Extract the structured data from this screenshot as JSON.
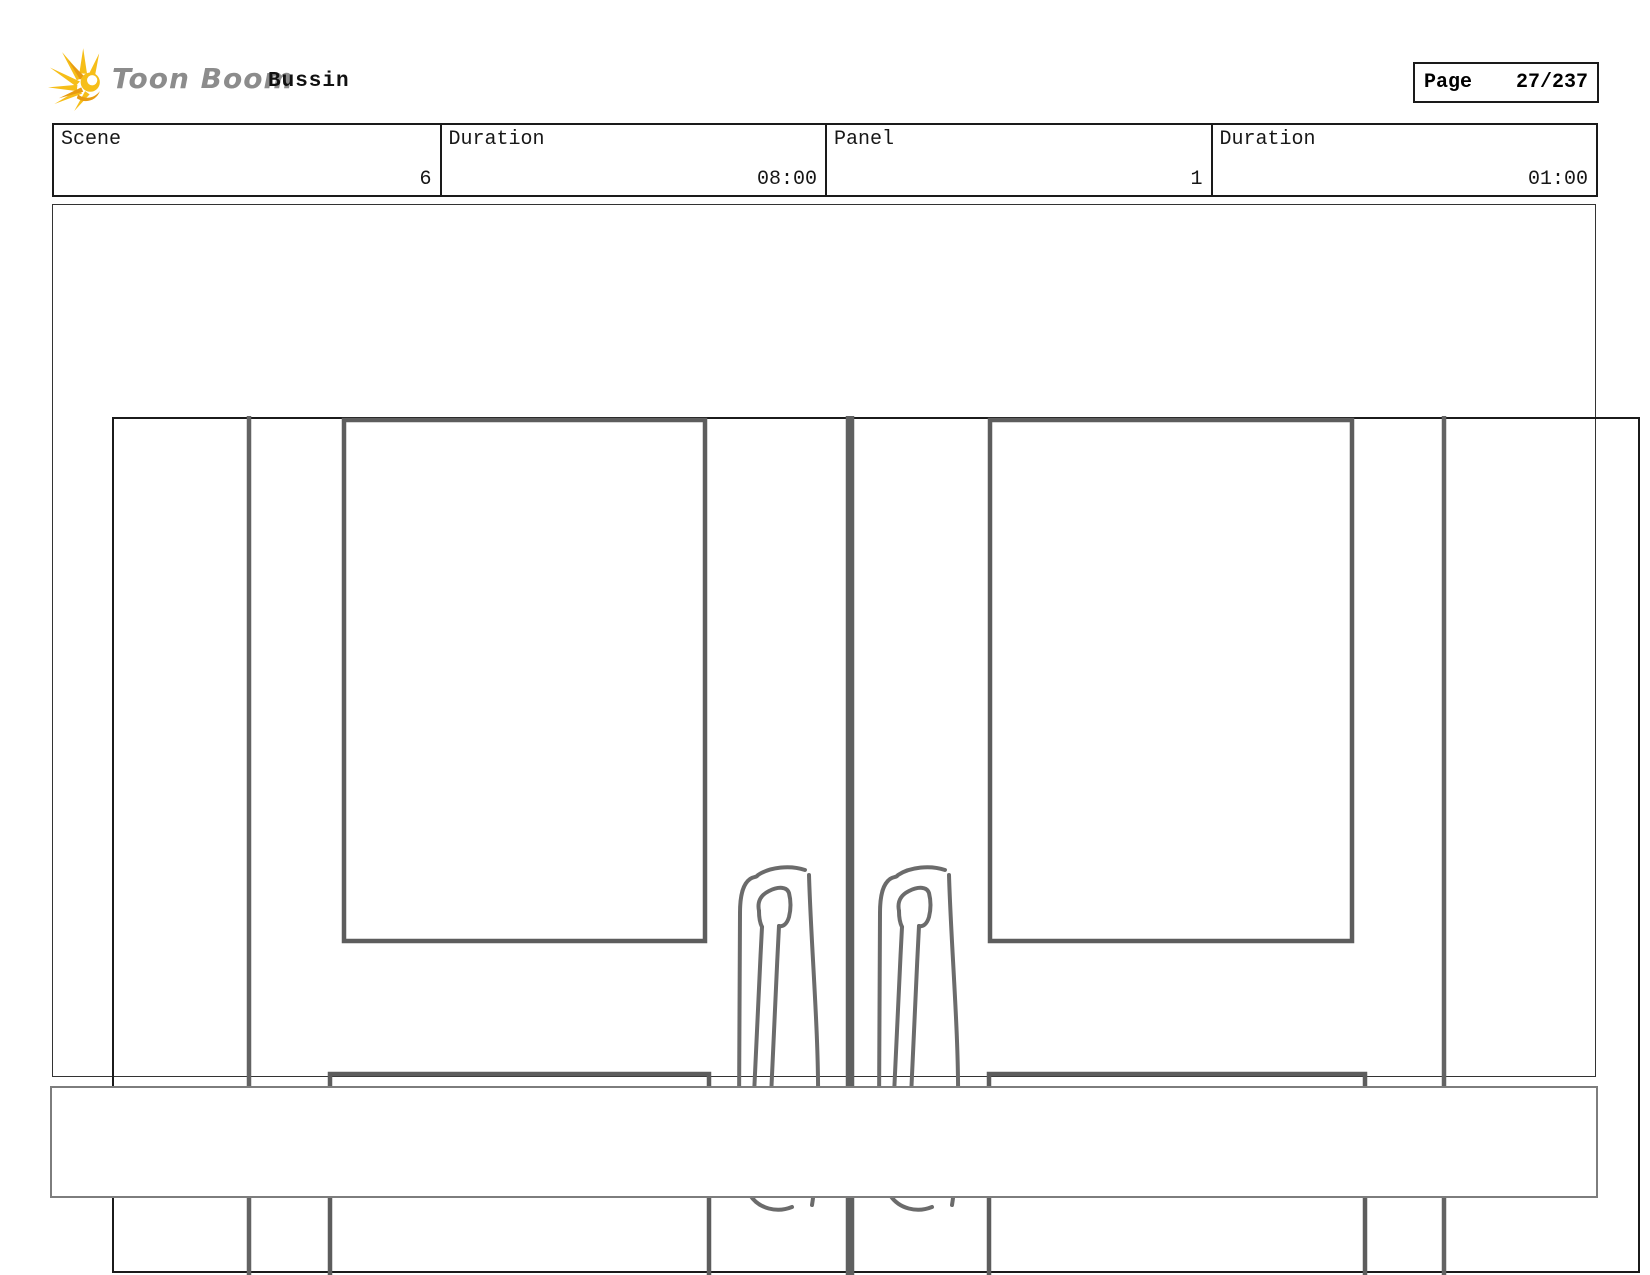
{
  "header": {
    "brand": "Toon Boom",
    "title": "Bussin",
    "page": {
      "label": "Page",
      "value": "27/237"
    }
  },
  "info_table": {
    "cells": [
      {
        "label": "Scene",
        "value": "6"
      },
      {
        "label": "Duration",
        "value": "08:00"
      },
      {
        "label": "Panel",
        "value": "1"
      },
      {
        "label": "Duration",
        "value": "01:00"
      }
    ]
  },
  "panel": {
    "drawing": "double-doors-sketch"
  },
  "caption": {
    "text": ""
  },
  "colors": {
    "logo_yellow": "#F6BE19",
    "logo_yellow_dark": "#E89B12",
    "brand_gray": "#8C8C8C",
    "sketch_gray": "#636363",
    "gap_gray": "#5F6060",
    "handle_gray": "#6B6B6B",
    "frame_black": "#1B1B1B"
  }
}
